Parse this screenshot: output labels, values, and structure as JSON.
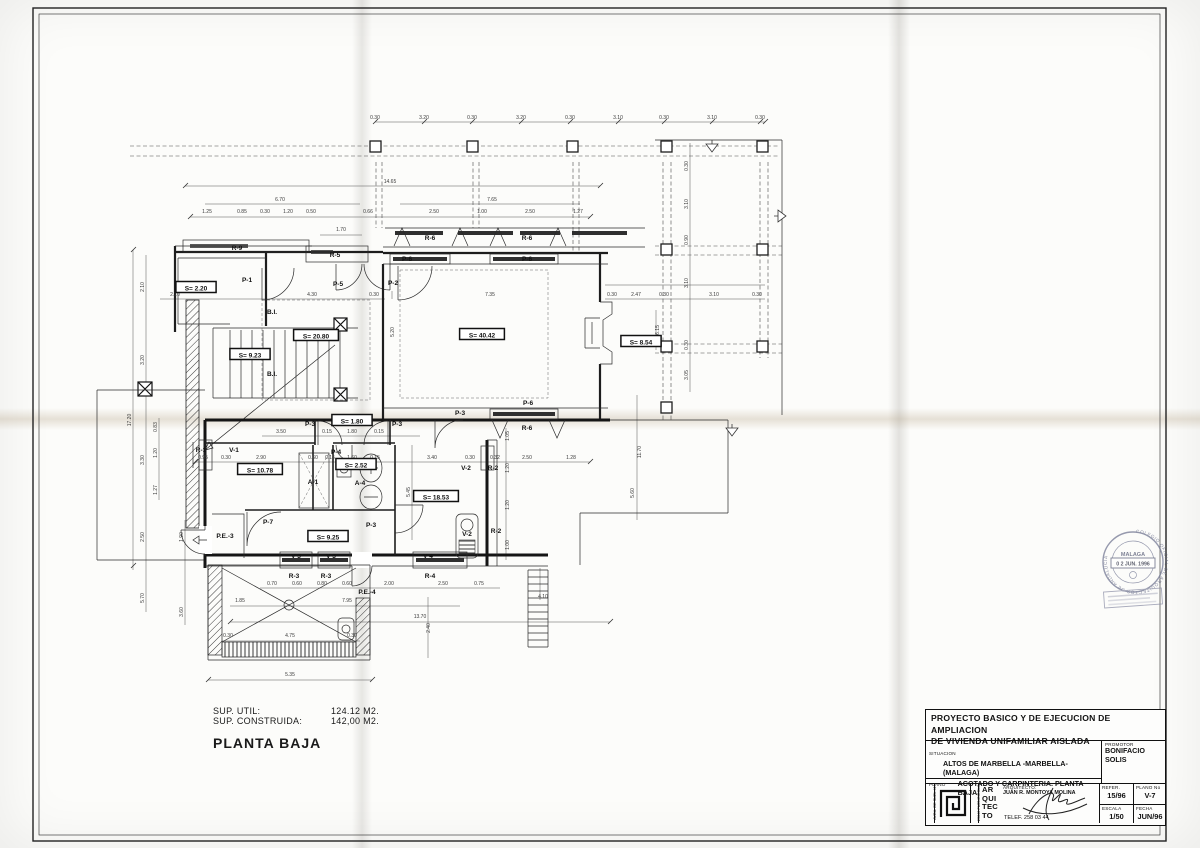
{
  "notes": {
    "sup_util_label": "SUP. UTIL:",
    "sup_util_value": "124.12 M2.",
    "sup_cons_label": "SUP. CONSTRUIDA:",
    "sup_cons_value": "142,00 M2.",
    "plan_title": "PLANTA BAJA"
  },
  "title_block": {
    "project_title_line1": "PROYECTO BASICO Y DE EJECUCION DE AMPLIACION",
    "project_title_line2": "DE VIVIENDA UNIFAMILIAR AISLADA",
    "situacion_label": "SITUACION",
    "situacion_value1": "ALTOS DE MARBELLA -MARBELLA-",
    "situacion_value2": "(MALAGA)",
    "promotor_label": "PROMOTOR",
    "promotor_value": "BONIFACIO SOLIS",
    "plano_label": "PLANO",
    "plano_value": "ACOTADO Y CARPINTERIA. PLANTA BAJA",
    "architect_label": "ARQUITECTO:",
    "architect_name": "JUAN R. MONTOYA MOLINA",
    "logo_word_1": "AR",
    "logo_word_2": "QUI",
    "logo_word_3": "TEC",
    "logo_word_4": "TO",
    "address_left": "AVDA. DE SUEL 41",
    "address_right": "29640 FUENGIROLA",
    "phone": "TELEF. 258 03 44",
    "refer_label": "REFER.",
    "refer_value": "15/96",
    "plano_no_label": "PLANO No",
    "plano_no_value": "V-7",
    "escala_label": "ESCALA",
    "fecha_label": "FECHA",
    "escala_value": "1/50",
    "fecha_value": "JUN/96"
  },
  "stamp": {
    "arc_text": "COLEGIO OFICIAL DE ARQUITECTOS DE ANDALUCIA",
    "city": "MALAGA",
    "date": "0 2 JUN. 1996"
  },
  "plan": {
    "rooms": [
      {
        "t": "S= 2.20",
        "x": 196,
        "y": 289
      },
      {
        "t": "S= 20.80",
        "x": 316,
        "y": 337
      },
      {
        "t": "S= 9.23",
        "x": 250,
        "y": 356
      },
      {
        "t": "S= 40.42",
        "x": 482,
        "y": 336
      },
      {
        "t": "S= 8.54",
        "x": 641,
        "y": 343
      },
      {
        "t": "S= 1.80",
        "x": 352,
        "y": 422
      },
      {
        "t": "S= 2.52",
        "x": 356,
        "y": 466
      },
      {
        "t": "S= 10.78",
        "x": 260,
        "y": 471
      },
      {
        "t": "S= 18.53",
        "x": 436,
        "y": 498
      },
      {
        "t": "S= 9.25",
        "x": 328,
        "y": 538
      }
    ],
    "openings": [
      {
        "t": "R-9",
        "x": 237,
        "y": 250
      },
      {
        "t": "R-5",
        "x": 335,
        "y": 257
      },
      {
        "t": "P-5",
        "x": 338,
        "y": 286
      },
      {
        "t": "P-1",
        "x": 247,
        "y": 282
      },
      {
        "t": "P-2",
        "x": 393,
        "y": 285
      },
      {
        "t": "R-6",
        "x": 430,
        "y": 240
      },
      {
        "t": "R-6",
        "x": 527,
        "y": 240
      },
      {
        "t": "P-6",
        "x": 407,
        "y": 261
      },
      {
        "t": "P-6",
        "x": 527,
        "y": 261
      },
      {
        "t": "P-6",
        "x": 528,
        "y": 405
      },
      {
        "t": "R-6",
        "x": 527,
        "y": 430
      },
      {
        "t": "P-3",
        "x": 460,
        "y": 415
      },
      {
        "t": "P-3",
        "x": 310,
        "y": 426
      },
      {
        "t": "P-3",
        "x": 397,
        "y": 426
      },
      {
        "t": "P-4",
        "x": 336,
        "y": 454
      },
      {
        "t": "A-1",
        "x": 313,
        "y": 484
      },
      {
        "t": "A-4",
        "x": 360,
        "y": 485
      },
      {
        "t": "B.I.",
        "x": 272,
        "y": 314
      },
      {
        "t": "B.I.",
        "x": 272,
        "y": 376
      },
      {
        "t": "R-1",
        "x": 201,
        "y": 452
      },
      {
        "t": "V-1",
        "x": 234,
        "y": 452
      },
      {
        "t": "V-2",
        "x": 466,
        "y": 470
      },
      {
        "t": "R-2",
        "x": 493,
        "y": 470
      },
      {
        "t": "V-2",
        "x": 467,
        "y": 536
      },
      {
        "t": "R-2",
        "x": 496,
        "y": 533
      },
      {
        "t": "P-7",
        "x": 268,
        "y": 524
      },
      {
        "t": "P-3",
        "x": 371,
        "y": 527
      },
      {
        "t": "P.E.-3",
        "x": 225,
        "y": 538
      },
      {
        "t": "V-3",
        "x": 296,
        "y": 558
      },
      {
        "t": "V-3",
        "x": 331,
        "y": 558
      },
      {
        "t": "V-4",
        "x": 428,
        "y": 558
      },
      {
        "t": "R-3",
        "x": 294,
        "y": 578
      },
      {
        "t": "R-3",
        "x": 326,
        "y": 578
      },
      {
        "t": "R-4",
        "x": 430,
        "y": 578
      },
      {
        "t": "P.E.-4",
        "x": 367,
        "y": 594
      }
    ],
    "dims": [
      {
        "t": "0.30",
        "x": 375,
        "y": 119
      },
      {
        "t": "3.20",
        "x": 424,
        "y": 119
      },
      {
        "t": "0.30",
        "x": 472,
        "y": 119
      },
      {
        "t": "3.20",
        "x": 521,
        "y": 119
      },
      {
        "t": "0.30",
        "x": 570,
        "y": 119
      },
      {
        "t": "3.10",
        "x": 618,
        "y": 119
      },
      {
        "t": "0.30",
        "x": 664,
        "y": 119
      },
      {
        "t": "3.10",
        "x": 712,
        "y": 119
      },
      {
        "t": "0.30",
        "x": 760,
        "y": 119
      },
      {
        "t": "14.65",
        "x": 390,
        "y": 183
      },
      {
        "t": "6.70",
        "x": 280,
        "y": 201
      },
      {
        "t": "7.65",
        "x": 492,
        "y": 201
      },
      {
        "t": "1.25",
        "x": 207,
        "y": 213
      },
      {
        "t": "0.85",
        "x": 242,
        "y": 213
      },
      {
        "t": "0.30",
        "x": 265,
        "y": 213
      },
      {
        "t": "1.20",
        "x": 288,
        "y": 213
      },
      {
        "t": "0.50",
        "x": 311,
        "y": 213
      },
      {
        "t": "0.66",
        "x": 368,
        "y": 213
      },
      {
        "t": "2.50",
        "x": 434,
        "y": 213
      },
      {
        "t": "1.00",
        "x": 482,
        "y": 213
      },
      {
        "t": "2.50",
        "x": 530,
        "y": 213
      },
      {
        "t": "1.27",
        "x": 578,
        "y": 213
      },
      {
        "t": "1.70",
        "x": 341,
        "y": 231
      },
      {
        "t": "2.10",
        "x": 175,
        "y": 296
      },
      {
        "t": "4.30",
        "x": 312,
        "y": 296
      },
      {
        "t": "0.30",
        "x": 374,
        "y": 296
      },
      {
        "t": "7.35",
        "x": 490,
        "y": 296
      },
      {
        "t": "0.30",
        "x": 612,
        "y": 296
      },
      {
        "t": "2.47",
        "x": 636,
        "y": 296
      },
      {
        "t": "0.30",
        "x": 664,
        "y": 296
      },
      {
        "t": "3.10",
        "x": 714,
        "y": 296
      },
      {
        "t": "0.30",
        "x": 757,
        "y": 296
      },
      {
        "t": "17.20",
        "x": 131,
        "y": 420,
        "v": 1
      },
      {
        "t": "2.10",
        "x": 144,
        "y": 287,
        "v": 1
      },
      {
        "t": "3.20",
        "x": 144,
        "y": 360,
        "v": 1
      },
      {
        "t": "3.30",
        "x": 144,
        "y": 460,
        "v": 1
      },
      {
        "t": "0.83",
        "x": 157,
        "y": 427,
        "v": 1
      },
      {
        "t": "1.20",
        "x": 157,
        "y": 453,
        "v": 1
      },
      {
        "t": "1.27",
        "x": 157,
        "y": 490,
        "v": 1
      },
      {
        "t": "2.50",
        "x": 144,
        "y": 537,
        "v": 1
      },
      {
        "t": "1.90",
        "x": 183,
        "y": 537,
        "v": 1
      },
      {
        "t": "5.70",
        "x": 144,
        "y": 598,
        "v": 1
      },
      {
        "t": "3.60",
        "x": 183,
        "y": 612,
        "v": 1
      },
      {
        "t": "5.20",
        "x": 394,
        "y": 332,
        "v": 1
      },
      {
        "t": "5.45",
        "x": 410,
        "y": 492,
        "v": 1
      },
      {
        "t": "5.60",
        "x": 634,
        "y": 493,
        "v": 1
      },
      {
        "t": "11.70",
        "x": 641,
        "y": 452,
        "v": 1
      },
      {
        "t": "6.15",
        "x": 659,
        "y": 330,
        "v": 1
      },
      {
        "t": "2.40",
        "x": 430,
        "y": 628,
        "v": 1
      },
      {
        "t": "0.30",
        "x": 688,
        "y": 166,
        "v": 1
      },
      {
        "t": "3.10",
        "x": 688,
        "y": 204,
        "v": 1
      },
      {
        "t": "0.90",
        "x": 688,
        "y": 240,
        "v": 1
      },
      {
        "t": "3.10",
        "x": 688,
        "y": 283,
        "v": 1
      },
      {
        "t": "0.30",
        "x": 688,
        "y": 345,
        "v": 1
      },
      {
        "t": "3.05",
        "x": 688,
        "y": 375,
        "v": 1
      },
      {
        "t": "3.50",
        "x": 281,
        "y": 433
      },
      {
        "t": "0.15",
        "x": 327,
        "y": 433
      },
      {
        "t": "1.80",
        "x": 352,
        "y": 433
      },
      {
        "t": "0.15",
        "x": 379,
        "y": 433
      },
      {
        "t": "0.95",
        "x": 203,
        "y": 459
      },
      {
        "t": "0.30",
        "x": 226,
        "y": 459
      },
      {
        "t": "2.90",
        "x": 261,
        "y": 459
      },
      {
        "t": "0.60",
        "x": 313,
        "y": 459
      },
      {
        "t": "0.15",
        "x": 330,
        "y": 459
      },
      {
        "t": "1.60",
        "x": 352,
        "y": 459
      },
      {
        "t": "0.15",
        "x": 375,
        "y": 459
      },
      {
        "t": "3.40",
        "x": 432,
        "y": 459
      },
      {
        "t": "0.30",
        "x": 470,
        "y": 459
      },
      {
        "t": "0.32",
        "x": 495,
        "y": 459
      },
      {
        "t": "2.50",
        "x": 527,
        "y": 459
      },
      {
        "t": "1.28",
        "x": 571,
        "y": 459
      },
      {
        "t": "1.05",
        "x": 509,
        "y": 436,
        "v": 1
      },
      {
        "t": "1.20",
        "x": 509,
        "y": 468,
        "v": 1
      },
      {
        "t": "1.20",
        "x": 509,
        "y": 505,
        "v": 1
      },
      {
        "t": "1.00",
        "x": 509,
        "y": 545,
        "v": 1
      },
      {
        "t": "0.70",
        "x": 272,
        "y": 585
      },
      {
        "t": "0.60",
        "x": 297,
        "y": 585
      },
      {
        "t": "0.80",
        "x": 322,
        "y": 585
      },
      {
        "t": "0.60",
        "x": 347,
        "y": 585
      },
      {
        "t": "2.00",
        "x": 389,
        "y": 585
      },
      {
        "t": "2.50",
        "x": 443,
        "y": 585
      },
      {
        "t": "0.75",
        "x": 479,
        "y": 585
      },
      {
        "t": "4.10",
        "x": 543,
        "y": 598
      },
      {
        "t": "1.85",
        "x": 240,
        "y": 602
      },
      {
        "t": "7.95",
        "x": 347,
        "y": 602
      },
      {
        "t": "13.70",
        "x": 420,
        "y": 618
      },
      {
        "t": "0.30",
        "x": 228,
        "y": 637
      },
      {
        "t": "4.75",
        "x": 290,
        "y": 637
      },
      {
        "t": "0.30",
        "x": 352,
        "y": 637
      },
      {
        "t": "5.35",
        "x": 290,
        "y": 676
      }
    ]
  }
}
